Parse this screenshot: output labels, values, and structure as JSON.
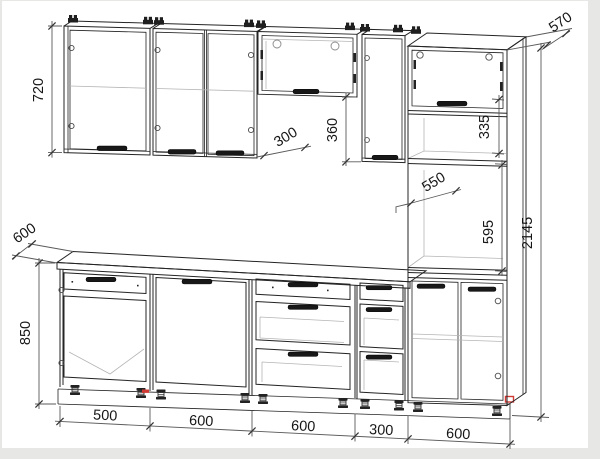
{
  "drawing": {
    "title": "kitchen-set-technical-drawing",
    "colors": {
      "line": "#242424",
      "dimension": "#5a5a5a",
      "accent_red": "#cf3a34",
      "paper": "#ffffff",
      "border": "#e7e7e6"
    },
    "dims": {
      "wall_cabinet_height": "720",
      "tall_cabinet_depth": "570",
      "wall_cabinet_depth": "300",
      "hood_cabinet_offset": "360",
      "tall_upper_niche_height": "335",
      "oven_niche_depth": "550",
      "oven_niche_height": "595",
      "total_height": "2145",
      "worktop_depth": "600",
      "base_cabinet_height": "850",
      "section_widths": [
        "500",
        "600",
        "600",
        "300",
        "600"
      ]
    }
  }
}
